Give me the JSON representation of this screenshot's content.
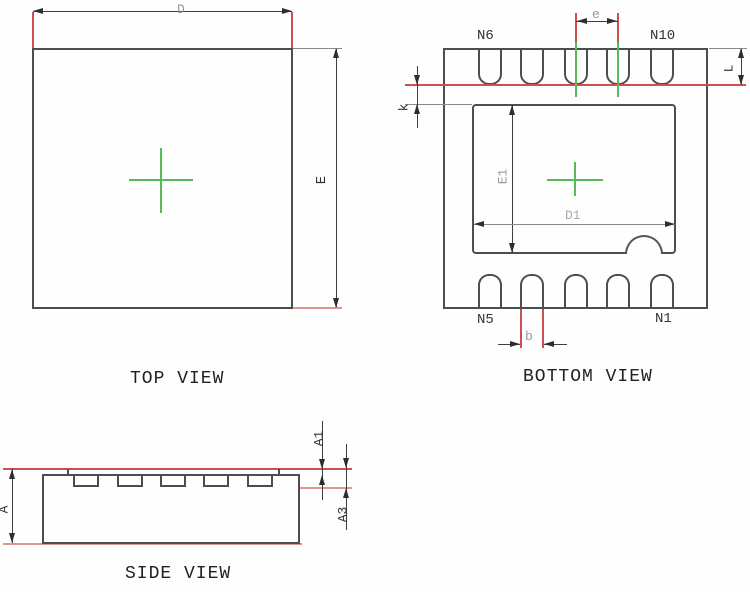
{
  "figure_type": "ic-package-outline-drawing",
  "top_view": {
    "title": "TOP VIEW",
    "dim_d": "D",
    "dim_e": "E"
  },
  "bottom_view": {
    "title": "BOTTOM VIEW",
    "dim_e": "e",
    "dim_l": "L",
    "dim_k": "k",
    "dim_e1": "E1",
    "dim_d1": "D1",
    "dim_b": "b",
    "pin_n6": "N6",
    "pin_n10": "N10",
    "pin_n5": "N5",
    "pin_n1": "N1"
  },
  "side_view": {
    "title": "SIDE VIEW",
    "dim_a": "A",
    "dim_a1": "A1",
    "dim_a3": "A3"
  },
  "colors": {
    "outline": "#4d4d4d",
    "dimension_line": "#3f3f3f",
    "extension_red": "#cc5050",
    "extension_pink": "#e09595",
    "centerline_green": "#57b957",
    "label_gray": "#999999",
    "background": "#fefefe"
  }
}
